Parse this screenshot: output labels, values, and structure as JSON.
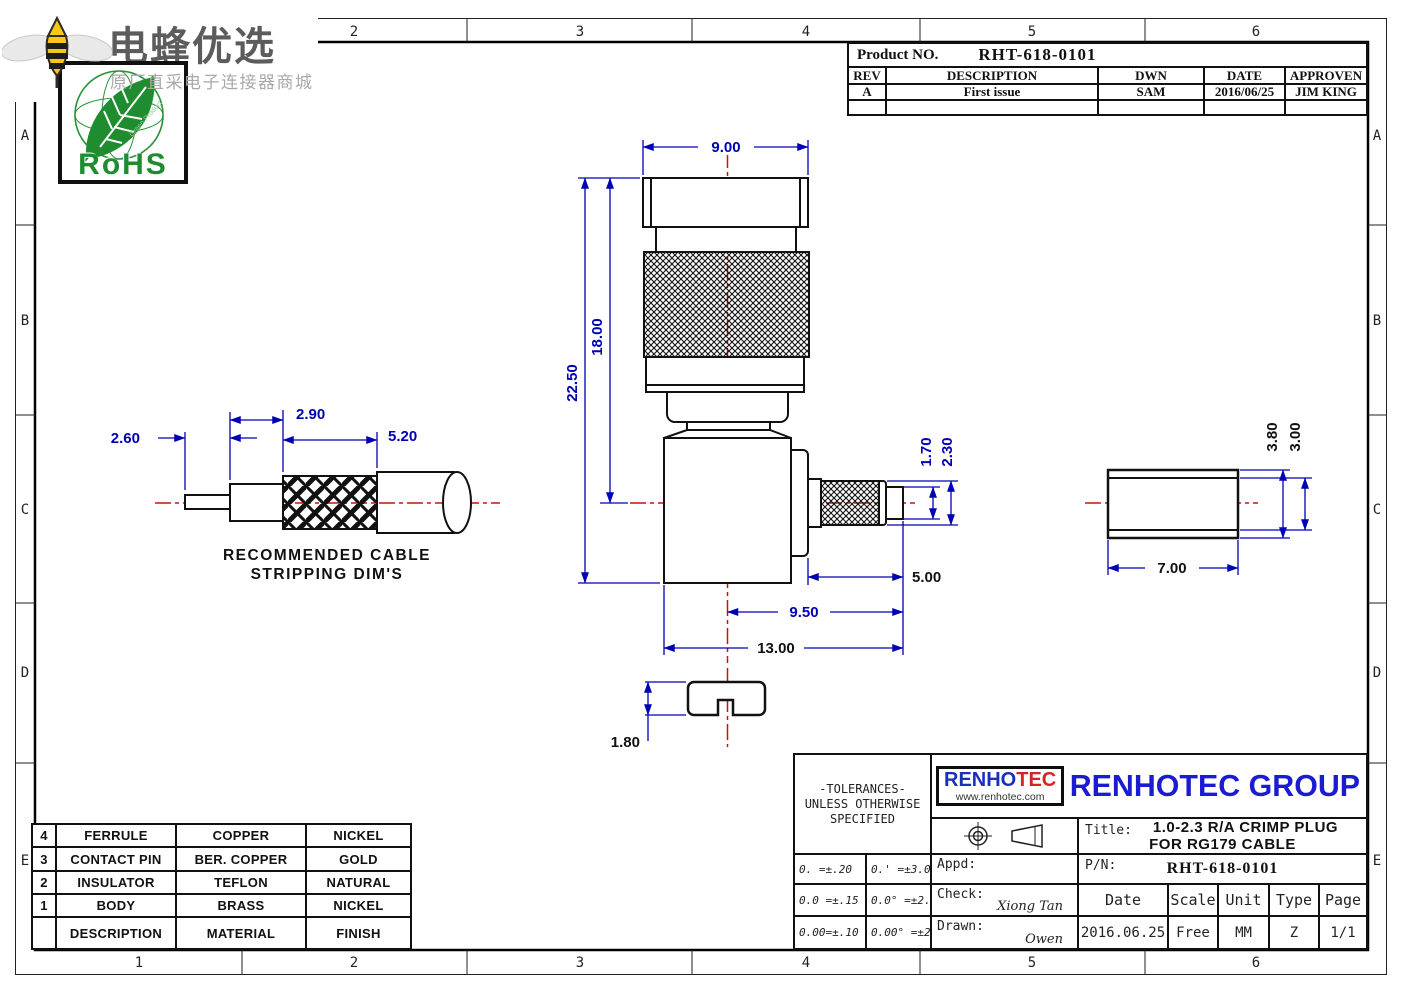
{
  "branding": {
    "logo_text": "电蜂优选",
    "logo_subtext": "原厂直采电子连接器商城",
    "rohs_label": "RoHS",
    "rohs_sub": "Green Product"
  },
  "zones": {
    "cols": [
      "1",
      "2",
      "3",
      "4",
      "5",
      "6"
    ],
    "rows": [
      "A",
      "B",
      "C",
      "D",
      "E"
    ]
  },
  "rev_block": {
    "product_label": "Product NO.",
    "product_no": "RHT-618-0101",
    "headers": [
      "REV",
      "DESCRIPTION",
      "DWN",
      "DATE",
      "APPROVEN"
    ],
    "rows": [
      [
        "A",
        "First issue",
        "SAM",
        "2016/06/25",
        "JIM KING"
      ]
    ]
  },
  "drawing": {
    "note_line1": "RECOMMENDED CABLE",
    "note_line2": "STRIPPING DIM'S",
    "dims": {
      "cap_width": "9.00",
      "body_len": "18.00",
      "total_len": "22.50",
      "strip_pin": "2.60",
      "strip_dielectric": "2.90",
      "strip_braid": "5.20",
      "crimp_id": "1.70",
      "crimp_od": "2.30",
      "barrel_len": "5.00",
      "side_len": "9.50",
      "total_width": "13.00",
      "slot_depth": "1.80",
      "ferrule_len": "7.00",
      "ferrule_od": "3.80",
      "ferrule_id": "3.00"
    }
  },
  "parts_table": {
    "rows": [
      [
        "4",
        "FERRULE",
        "COPPER",
        "NICKEL"
      ],
      [
        "3",
        "CONTACT PIN",
        "BER. COPPER",
        "GOLD"
      ],
      [
        "2",
        "INSULATOR",
        "TEFLON",
        "NATURAL"
      ],
      [
        "1",
        "BODY",
        "BRASS",
        "NICKEL"
      ],
      [
        "",
        "DESCRIPTION",
        "MATERIAL",
        "FINISH"
      ]
    ]
  },
  "title_block": {
    "tolerances": {
      "line1": "-TOLERANCES-",
      "line2": "UNLESS OTHERWISE",
      "line3": "SPECIFIED",
      "values": [
        [
          "0. =±.20",
          "0.' =±3.0'"
        ],
        [
          "0.0 =±.15",
          "0.0° =±2.5°"
        ],
        [
          "0.00=±.10",
          "0.00° =±2.0°"
        ]
      ]
    },
    "logo": {
      "part1": "RENHO",
      "part2": "TEC",
      "url": "www.renhotec.com"
    },
    "company": "RENHOTEC GROUP",
    "title_label": "Title:",
    "title_line1": "1.0-2.3 R/A CRIMP PLUG",
    "title_line2": "FOR RG179 CABLE",
    "pn_label": "P/N:",
    "pn_value": "RHT-618-0101",
    "appd_label": "Appd:",
    "check_label": "Check:",
    "check_name": "Xiong Tan",
    "drawn_label": "Drawn:",
    "drawn_name": "Owen",
    "cols": {
      "date_label": "Date",
      "scale_label": "Scale",
      "unit_label": "Unit",
      "type_label": "Type",
      "page_label": "Page",
      "date": "2016.06.25",
      "scale": "Free",
      "unit": "MM",
      "type": "Z",
      "page": "1/1"
    }
  },
  "colors": {
    "dim_blue": "#0000b4",
    "center_red": "#c21807",
    "brand_blue": "#1b1bd1",
    "brand_red": "#d42424",
    "rohs_green": "#1f8c2f"
  }
}
